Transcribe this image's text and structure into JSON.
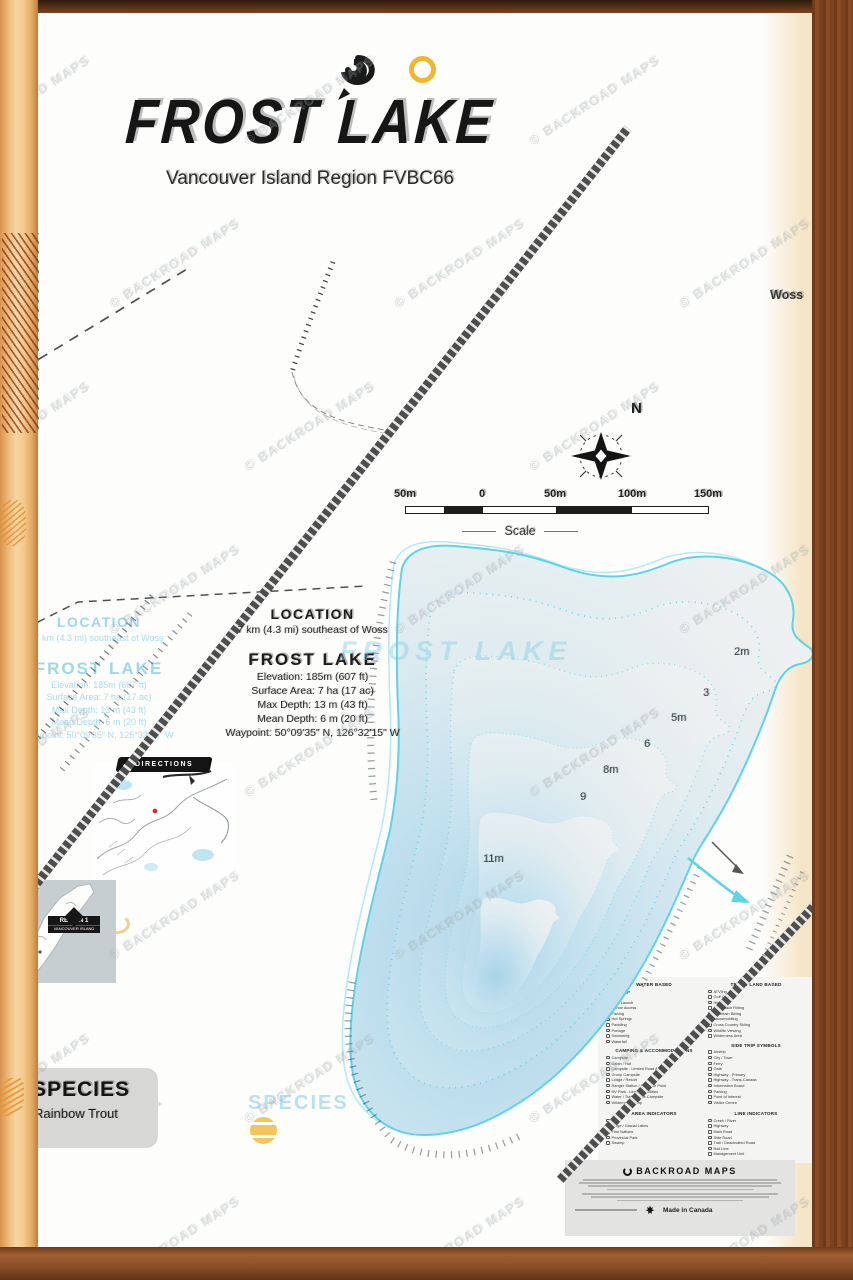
{
  "brand": {
    "watermark": "© BACKROAD MAPS",
    "footer_name": "BACKROAD MAPS",
    "made_in": "Made in Canada"
  },
  "header": {
    "title": "FROST LAKE",
    "subtitle": "Vancouver Island Region FVBC66"
  },
  "map": {
    "place_label": "Woss",
    "north_label": "N",
    "depth_labels": [
      {
        "t": "2m",
        "x": 734,
        "y": 646
      },
      {
        "t": "3",
        "x": 703,
        "y": 687
      },
      {
        "t": "5m",
        "x": 671,
        "y": 712
      },
      {
        "t": "6",
        "x": 644,
        "y": 738
      },
      {
        "t": "8m",
        "x": 603,
        "y": 764
      },
      {
        "t": "9",
        "x": 580,
        "y": 791
      },
      {
        "t": "11m",
        "x": 483,
        "y": 853
      }
    ]
  },
  "scale": {
    "labels": [
      "50m",
      "0",
      "50m",
      "100m",
      "150m"
    ],
    "xs": [
      405,
      482,
      555,
      632,
      708
    ],
    "caption": "Scale"
  },
  "location": {
    "heading": "LOCATION",
    "text": "7 km (4.3 mi) southeast of Woss"
  },
  "lake_info": {
    "heading": "FROST LAKE",
    "stats": [
      "Elevation: 185m (607 ft)",
      "Surface Area: 7 ha (17 ac)",
      "Max Depth: 13 m (43 ft)",
      "Mean Depth: 6 m (20 ft)",
      "Waypoint: 50°09'35\" N, 126°32'15\" W"
    ]
  },
  "species": {
    "heading": "SPECIES",
    "items": [
      "Rainbow Trout"
    ]
  },
  "insets": {
    "directions_label": "DIRECTIONS",
    "region_badge": {
      "line1": "REGION 1",
      "line2": "VANCOUVER ISLAND"
    }
  },
  "legend": {
    "columns": [
      [
        {
          "title": "WATER BASED",
          "items": [
            "Anchorage",
            "Beach",
            "Boat Launch",
            "Canoe Access",
            "Fishing",
            "Hot Springs",
            "Paddling",
            "Portage",
            "Swimming",
            "Waterfall"
          ]
        },
        {
          "title": "CAMPING & ACCOMMODATIONS",
          "items": [
            "Campsite",
            "Cabin / Hut",
            "Campsite - Limited Road Access",
            "Group Campsite",
            "Lodge / Resort",
            "Ranger Station / Entrance Point",
            "RV Park - Limited Facilities",
            "Water / Trail Access Campsite",
            "Wilderness Camp"
          ]
        }
      ],
      [
        {
          "title": "TRAIL / LAND BASED",
          "items": [
            "ATV'ing",
            "Golf Course",
            "Hiking",
            "Horseback Riding",
            "Mountain Biking",
            "Snowmobiling",
            "Cross Country Skiing",
            "Wildlife Viewing",
            "Wilderness Area"
          ]
        },
        {
          "title": "SIDE TRIP SYMBOLS",
          "items": [
            "Airstrip",
            "City / Town",
            "Ferry",
            "Gate",
            "Highway - Primary",
            "Highway - Trans-Canada",
            "Information Board",
            "Parking",
            "Point of Interest",
            "Visitor Centre"
          ]
        }
      ],
      [
        {
          "title": "AREA INDICATORS",
          "items": [
            "Lake",
            "Large / Glacial Lakes",
            "First Nations",
            "Provincial Park",
            "Swamp"
          ]
        }
      ],
      [
        {
          "title": "LINE INDICATORS",
          "items": [
            "Creek / River",
            "Highway",
            "Main Road",
            "Side Road",
            "Trail / Deactivated Road",
            "Rail Line",
            "Management Unit"
          ]
        }
      ]
    ]
  },
  "colors": {
    "accent_gold": "#F0B62C",
    "lake_outline": "#5FD3E6",
    "lake_deep": "#AFD6E8",
    "ghost_cyan": "#8FD4E8",
    "railway": "#4F4F4F",
    "frame_light": "#E9B169",
    "frame_dark": "#7C4220"
  }
}
